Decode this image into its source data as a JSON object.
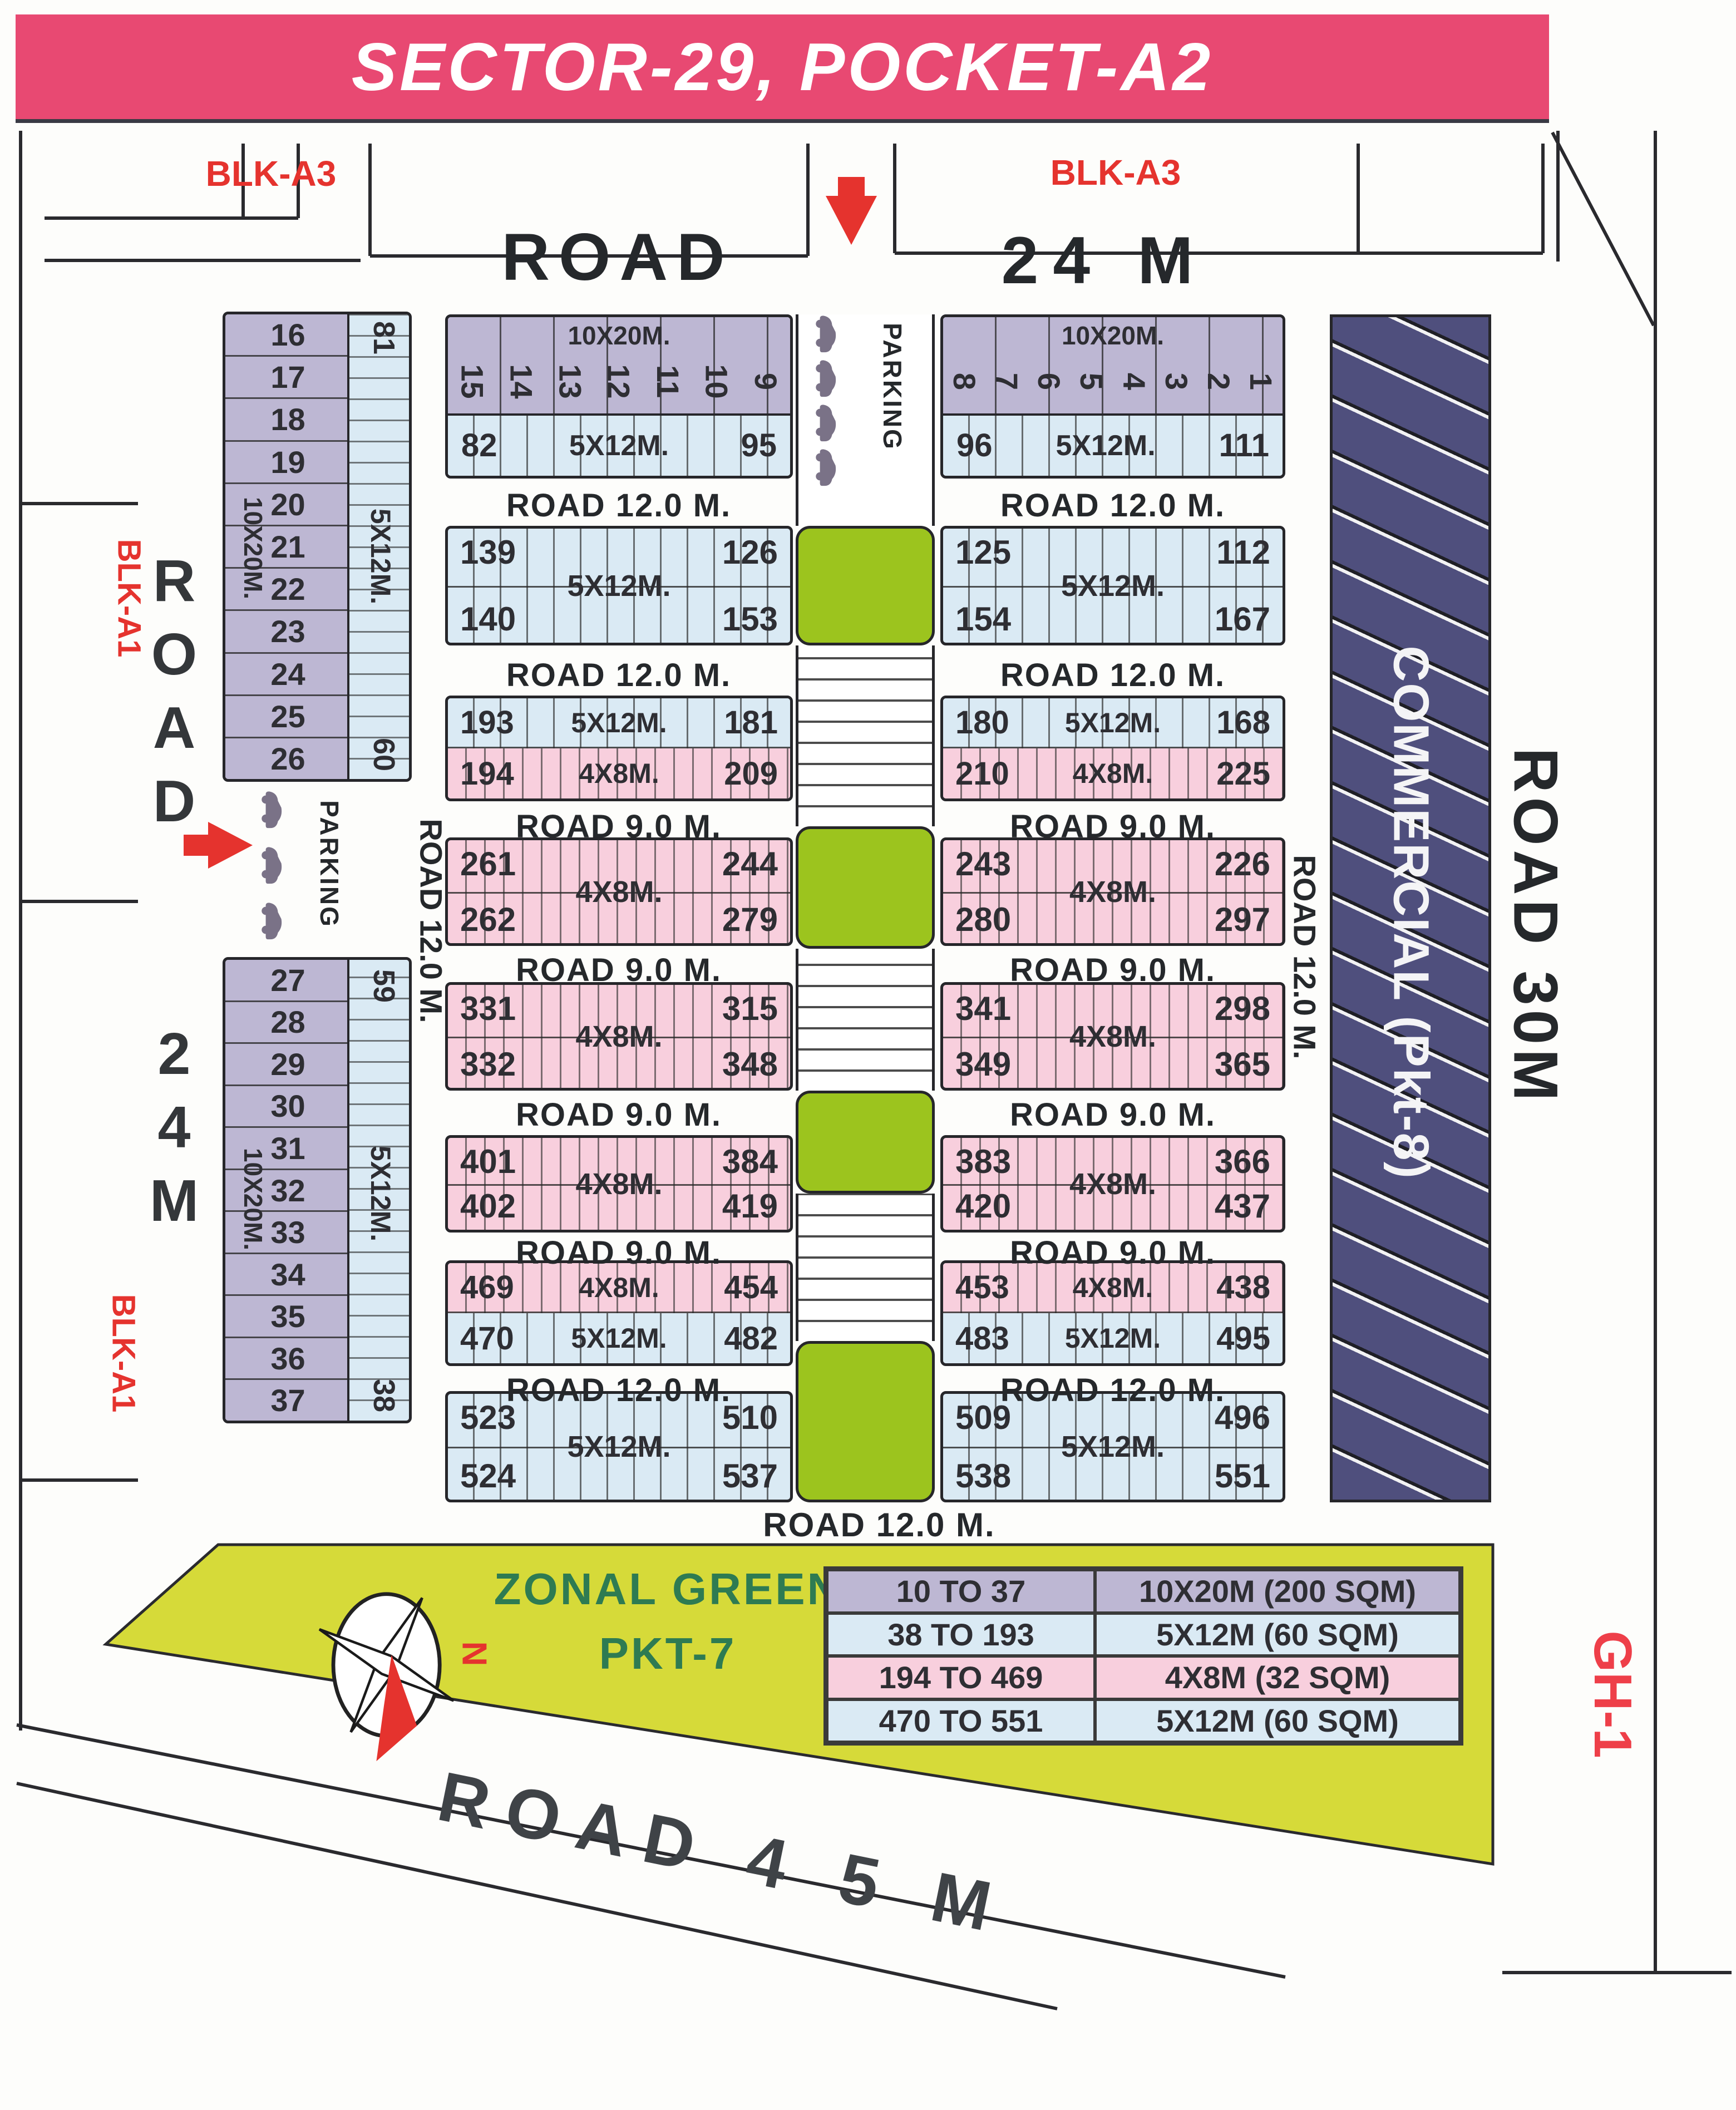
{
  "title": "SECTOR-29, POCKET-A2",
  "colors": {
    "banner_pink": "#e84972",
    "plot_purple": "#bdb7d3",
    "plot_blue": "#daeaf4",
    "plot_pink": "#f8cfdd",
    "green_median": "#9cc41e",
    "zonal_yellow": "#d6da39",
    "commercial_navy": "#4f4f7d",
    "accent_red": "#e5332e",
    "ink": "#25282b"
  },
  "top": {
    "blk_left": "BLK-A3",
    "blk_right": "BLK-A3",
    "road": "ROAD",
    "width": "24 M"
  },
  "left_corridor": {
    "road": "ROAD",
    "width": "24M",
    "blk1": "BLK-A1",
    "blk2": "BLK-A1",
    "parking": "PARKING"
  },
  "median_parking": "PARKING",
  "side_roads": {
    "left_v": "ROAD 12.0 M.",
    "right_v": "ROAD 12.0 M.",
    "road30": "ROAD 30M",
    "gh1": "GH-1"
  },
  "commercial": "COMMERCIAL (Pkt-8)",
  "roads": {
    "r12": "ROAD 12.0 M.",
    "r9": "ROAD 9.0 M."
  },
  "colA": {
    "dim_big": "10X20M.",
    "dim_small": "5X12M.",
    "plots": [
      "16",
      "17",
      "18",
      "19",
      "20",
      "21",
      "22",
      "23",
      "24",
      "25",
      "26"
    ],
    "corner_top": "81",
    "corner_bottom": "60"
  },
  "colB": {
    "dim_big": "10X20M.",
    "dim_small": "5X12M.",
    "plots": [
      "27",
      "28",
      "29",
      "30",
      "31",
      "32",
      "33",
      "34",
      "35",
      "36",
      "37"
    ],
    "corner_top": "59",
    "corner_bottom": "38"
  },
  "row1L": {
    "dim_big": "10X20M.",
    "plots": [
      "15",
      "14",
      "13",
      "12",
      "11",
      "10",
      "9"
    ],
    "left": "82",
    "dim_small": "5X12M.",
    "right": "95"
  },
  "row1R": {
    "dim_big": "10X20M.",
    "plots": [
      "8",
      "7",
      "6",
      "5",
      "4",
      "3",
      "2",
      "1"
    ],
    "left": "96",
    "dim_small": "5X12M.",
    "right": "111"
  },
  "quads": {
    "row2L": {
      "tl": "139",
      "tr": "126",
      "bl": "140",
      "br": "153",
      "dim": "5X12M."
    },
    "row2R": {
      "tl": "125",
      "tr": "112",
      "bl": "154",
      "br": "167",
      "dim": "5X12M."
    },
    "row4L": {
      "tl": "261",
      "tr": "244",
      "bl": "262",
      "br": "279",
      "dim": "4X8M."
    },
    "row4R": {
      "tl": "243",
      "tr": "226",
      "bl": "280",
      "br": "297",
      "dim": "4X8M."
    },
    "row5L": {
      "tl": "331",
      "tr": "315",
      "bl": "332",
      "br": "348",
      "dim": "4X8M."
    },
    "row5R": {
      "tl": "341",
      "tr": "298",
      "bl": "349",
      "br": "365",
      "dim": "4X8M."
    },
    "row6L": {
      "tl": "401",
      "tr": "384",
      "bl": "402",
      "br": "419",
      "dim": "4X8M."
    },
    "row6R": {
      "tl": "383",
      "tr": "366",
      "bl": "420",
      "br": "437",
      "dim": "4X8M."
    },
    "row8L": {
      "tl": "523",
      "tr": "510",
      "bl": "524",
      "br": "537",
      "dim": "5X12M."
    },
    "row8R": {
      "tl": "509",
      "tr": "496",
      "bl": "538",
      "br": "551",
      "dim": "5X12M."
    }
  },
  "twobands": {
    "row3L": {
      "t_l": "193",
      "t_d": "5X12M.",
      "t_r": "181",
      "b_l": "194",
      "b_d": "4X8M.",
      "b_r": "209"
    },
    "row3R": {
      "t_l": "180",
      "t_d": "5X12M.",
      "t_r": "168",
      "b_l": "210",
      "b_d": "4X8M.",
      "b_r": "225"
    },
    "row7L": {
      "t_l": "469",
      "t_d": "4X8M.",
      "t_r": "454",
      "b_l": "470",
      "b_d": "5X12M.",
      "b_r": "482"
    },
    "row7R": {
      "t_l": "453",
      "t_d": "4X8M.",
      "t_r": "438",
      "b_l": "483",
      "b_d": "5X12M.",
      "b_r": "495"
    }
  },
  "zonal": {
    "line1": "ZONAL GREEN",
    "line2": "PKT-7"
  },
  "legend": [
    {
      "range": "10 TO 37",
      "size": "10X20M (200 SQM)",
      "tone": "purple"
    },
    {
      "range": "38 TO 193",
      "size": "5X12M (60 SQM)",
      "tone": "blue"
    },
    {
      "range": "194 TO 469",
      "size": "4X8M (32 SQM)",
      "tone": "pink"
    },
    {
      "range": "470 TO 551",
      "size": "5X12M (60 SQM)",
      "tone": "blue"
    }
  ],
  "bottom_road": "ROAD 4 5 M",
  "compass_north": "N"
}
